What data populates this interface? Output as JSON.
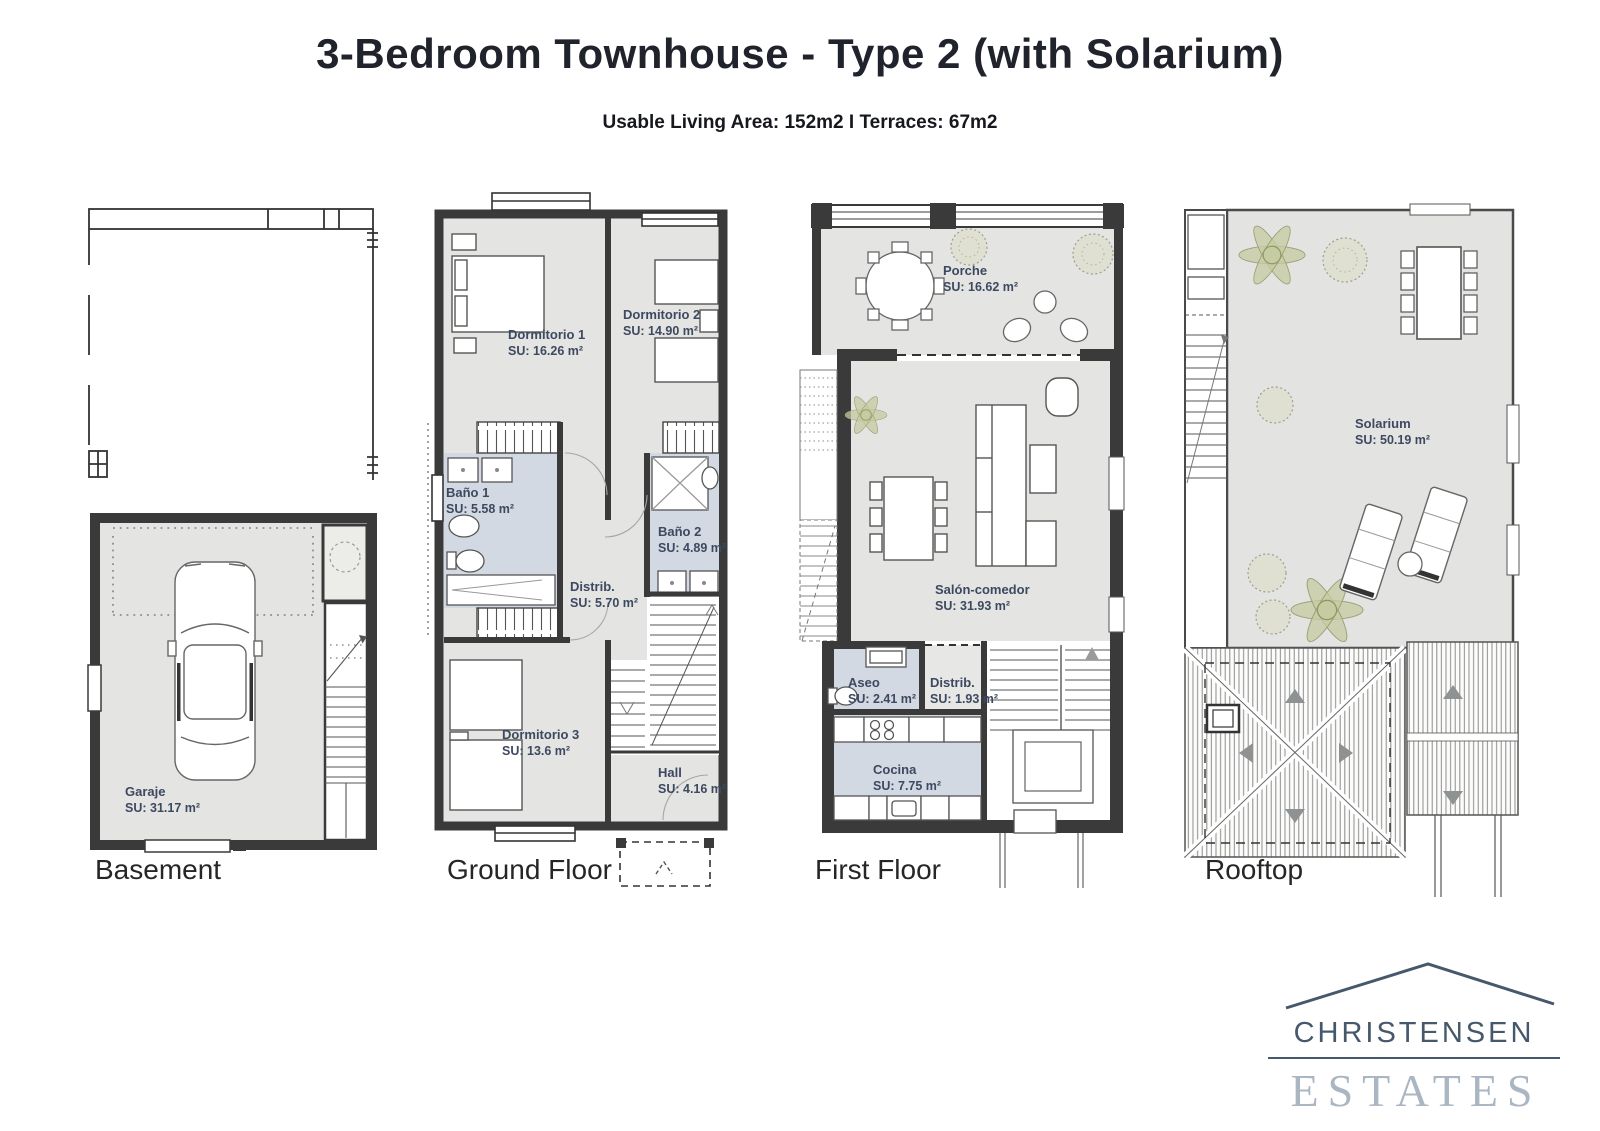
{
  "header": {
    "title": "3-Bedroom Townhouse - Type 2 (with Solarium)",
    "subtitle": "Usable Living Area: 152m2 I Terraces: 67m2"
  },
  "floors": [
    {
      "name": "Basement",
      "rooms": [
        {
          "label": "Garaje",
          "area": "SU: 31.17 m²"
        }
      ]
    },
    {
      "name": "Ground Floor",
      "rooms": [
        {
          "label": "Dormitorio 1",
          "area": "SU: 16.26 m²"
        },
        {
          "label": "Dormitorio 2",
          "area": "SU: 14.90 m²"
        },
        {
          "label": "Baño 1",
          "area": "SU: 5.58 m²"
        },
        {
          "label": "Distrib.",
          "area": "SU: 5.70 m²"
        },
        {
          "label": "Baño 2",
          "area": "SU: 4.89 m²"
        },
        {
          "label": "Dormitorio 3",
          "area": "SU: 13.6 m²"
        },
        {
          "label": "Hall",
          "area": "SU: 4.16 m²"
        }
      ]
    },
    {
      "name": "First Floor",
      "rooms": [
        {
          "label": "Porche",
          "area": "SU: 16.62 m²"
        },
        {
          "label": "Salón-comedor",
          "area": "SU: 31.93 m²"
        },
        {
          "label": "Aseo",
          "area": "SU: 2.41 m²"
        },
        {
          "label": "Distrib.",
          "area": "SU: 1.93 m²"
        },
        {
          "label": "Cocina",
          "area": "SU: 7.75 m²"
        }
      ]
    },
    {
      "name": "Rooftop",
      "rooms": [
        {
          "label": "Solarium",
          "area": "SU: 50.19 m²"
        }
      ]
    }
  ],
  "logo": {
    "line1": "CHRISTENSEN",
    "line2": "ESTATES"
  },
  "colors": {
    "wall": "#3a3a3a",
    "room_fill": "#e4e4e2",
    "wet_room_fill": "#d3d9e3",
    "room_label": "#3d4960",
    "logo_primary": "#46586c",
    "logo_secondary": "#aab6c1",
    "plant": "#c3c89c"
  }
}
